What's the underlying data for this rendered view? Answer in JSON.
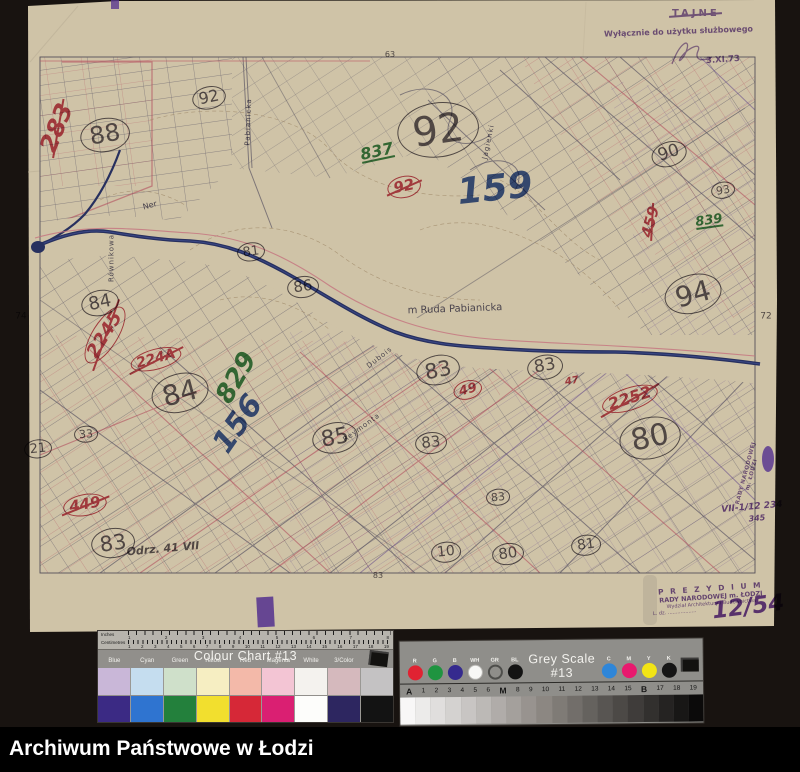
{
  "palette": {
    "background": "#181310",
    "paper": "#cfc3a7",
    "river": "#27305f",
    "pencil": "#55505a",
    "red": "#c13c4e",
    "green": "#2f7d3f",
    "blue": "#30509f",
    "purple": "#6b43a0",
    "ink": "#4d4a6a"
  },
  "archive_bar": {
    "label": "Archiwum Państwowe w Łodzi"
  },
  "stamps": {
    "top_right": {
      "secret": "TAJNE",
      "usage": "Wyłącznie do użytku służbowego",
      "date": "3.XI.73"
    },
    "bottom_right": {
      "line1": "P R E Z Y D I U M",
      "line2": "RADY NARODOWEJ m. ŁODZI",
      "line3": "Wydział Architektury i Budownictwa",
      "line4": "L. dz. ..................",
      "number": "12/54"
    },
    "right_edge": {
      "line1": "RADY NARODOWEJ",
      "line2": "m. ŁODZI",
      "note1": "VII-1/12 234",
      "note2": "345"
    }
  },
  "map": {
    "annotations": [
      {
        "text": "m Ruda Pabianicka",
        "x": 455,
        "y": 310,
        "size": 10,
        "color": "ink",
        "rot": -2
      },
      {
        "text": "Równikowa",
        "x": 112,
        "y": 258,
        "size": 7,
        "color": "ink",
        "rot": -90,
        "sp": true
      },
      {
        "text": "Pabianicka",
        "x": 249,
        "y": 122,
        "size": 7,
        "color": "ink",
        "rot": -88,
        "sp": true
      },
      {
        "text": "Jagienki",
        "x": 489,
        "y": 142,
        "size": 7,
        "color": "ink",
        "rot": -78,
        "sp": true
      },
      {
        "text": "Dubois",
        "x": 380,
        "y": 358,
        "size": 7,
        "color": "ink",
        "rot": -38,
        "sp": true
      },
      {
        "text": "Reymonta",
        "x": 362,
        "y": 428,
        "size": 7,
        "color": "ink",
        "rot": -36,
        "sp": true
      },
      {
        "text": "Ner",
        "x": 150,
        "y": 206,
        "size": 8,
        "color": "ink",
        "rot": -15
      },
      {
        "text": "88",
        "x": 105,
        "y": 135,
        "size": 24,
        "color": "pencil",
        "circle": true,
        "rot": -10
      },
      {
        "text": "92",
        "x": 209,
        "y": 98,
        "size": 16,
        "color": "pencil",
        "circle": true,
        "rot": -12
      },
      {
        "text": "92",
        "x": 438,
        "y": 130,
        "size": 40,
        "color": "pencil",
        "circle": true,
        "rot": -8
      },
      {
        "text": "81",
        "x": 251,
        "y": 252,
        "size": 13,
        "color": "pencil",
        "circle": true,
        "rot": -8
      },
      {
        "text": "86",
        "x": 303,
        "y": 287,
        "size": 15,
        "color": "pencil",
        "circle": true,
        "rot": -8
      },
      {
        "text": "84",
        "x": 100,
        "y": 303,
        "size": 18,
        "color": "pencil",
        "circle": true,
        "rot": -12
      },
      {
        "text": "84",
        "x": 180,
        "y": 393,
        "size": 28,
        "color": "pencil",
        "circle": true,
        "rot": -15
      },
      {
        "text": "85",
        "x": 335,
        "y": 438,
        "size": 22,
        "color": "pencil",
        "circle": true,
        "rot": -10
      },
      {
        "text": "83",
        "x": 438,
        "y": 370,
        "size": 21,
        "color": "pencil",
        "circle": true,
        "rot": -12
      },
      {
        "text": "83",
        "x": 431,
        "y": 443,
        "size": 15,
        "color": "pencil",
        "circle": true,
        "rot": -6
      },
      {
        "text": "83",
        "x": 113,
        "y": 543,
        "size": 21,
        "color": "pencil",
        "circle": true,
        "rot": -8
      },
      {
        "text": "83",
        "x": 545,
        "y": 367,
        "size": 17,
        "color": "pencil",
        "circle": true,
        "rot": -10
      },
      {
        "text": "80",
        "x": 650,
        "y": 438,
        "size": 30,
        "color": "pencil",
        "circle": true,
        "rot": -12
      },
      {
        "text": "94",
        "x": 693,
        "y": 294,
        "size": 28,
        "color": "pencil",
        "circle": true,
        "rot": -15
      },
      {
        "text": "90",
        "x": 669,
        "y": 154,
        "size": 17,
        "color": "pencil",
        "circle": true,
        "rot": -18
      },
      {
        "text": "93",
        "x": 723,
        "y": 190,
        "size": 11,
        "color": "pencil",
        "circle": true,
        "rot": -10
      },
      {
        "text": "10",
        "x": 446,
        "y": 552,
        "size": 14,
        "color": "pencil",
        "circle": true,
        "rot": -6
      },
      {
        "text": "80",
        "x": 508,
        "y": 554,
        "size": 15,
        "color": "pencil",
        "circle": true,
        "rot": -8
      },
      {
        "text": "81",
        "x": 586,
        "y": 545,
        "size": 14,
        "color": "pencil",
        "circle": true,
        "rot": -8
      },
      {
        "text": "21",
        "x": 38,
        "y": 449,
        "size": 13,
        "color": "pencil",
        "circle": true,
        "rot": -6
      },
      {
        "text": "33",
        "x": 86,
        "y": 434,
        "size": 11,
        "color": "pencil",
        "circle": true,
        "rot": -4
      },
      {
        "text": "83",
        "x": 498,
        "y": 497,
        "size": 11,
        "color": "pencil",
        "circle": true,
        "rot": -6
      },
      {
        "text": "63",
        "x": 390,
        "y": 55,
        "size": 8,
        "color": "pencil"
      },
      {
        "text": "83",
        "x": 378,
        "y": 576,
        "size": 8,
        "color": "pencil"
      },
      {
        "text": "74",
        "x": 21,
        "y": 317,
        "size": 9,
        "color": "pencil"
      },
      {
        "text": "72",
        "x": 766,
        "y": 317,
        "size": 9,
        "color": "pencil"
      },
      {
        "text": "Odrz. 41 VII",
        "x": 163,
        "y": 549,
        "size": 11,
        "color": "pencil",
        "rot": -5,
        "hand": true
      },
      {
        "text": "283",
        "x": 57,
        "y": 128,
        "size": 24,
        "color": "red",
        "rot": -68,
        "cross": true,
        "hand": true
      },
      {
        "text": "92",
        "x": 404,
        "y": 187,
        "size": 15,
        "color": "red",
        "circle": true,
        "cross": true,
        "rot": -12,
        "hand": true
      },
      {
        "text": "2245",
        "x": 105,
        "y": 335,
        "size": 18,
        "color": "red",
        "rot": -58,
        "circle": true,
        "cross": true,
        "hand": true
      },
      {
        "text": "224A",
        "x": 156,
        "y": 359,
        "size": 14,
        "color": "red",
        "rot": -15,
        "circle": true,
        "cross": true,
        "hand": true
      },
      {
        "text": "2252",
        "x": 630,
        "y": 399,
        "size": 16,
        "color": "red",
        "rot": -18,
        "circle": true,
        "cross": true,
        "hand": true
      },
      {
        "text": "459",
        "x": 651,
        "y": 222,
        "size": 15,
        "color": "red",
        "rot": -75,
        "cross": true,
        "hand": true
      },
      {
        "text": "49",
        "x": 468,
        "y": 390,
        "size": 13,
        "color": "red",
        "circle": true,
        "rot": -15,
        "hand": true
      },
      {
        "text": "449",
        "x": 85,
        "y": 505,
        "size": 15,
        "color": "red",
        "circle": true,
        "cross": true,
        "rot": -10,
        "hand": true
      },
      {
        "text": "47",
        "x": 572,
        "y": 382,
        "size": 10,
        "color": "red",
        "rot": -10,
        "hand": true
      },
      {
        "text": "837",
        "x": 377,
        "y": 152,
        "size": 16,
        "color": "green",
        "rot": -12,
        "underline": true,
        "hand": true
      },
      {
        "text": "829",
        "x": 237,
        "y": 378,
        "size": 26,
        "color": "green",
        "rot": -60,
        "hand": true
      },
      {
        "text": "839",
        "x": 709,
        "y": 221,
        "size": 13,
        "color": "green",
        "rot": -8,
        "underline": true,
        "hand": true
      },
      {
        "text": "159",
        "x": 495,
        "y": 189,
        "size": 36,
        "color": "blue",
        "rot": -6,
        "hand": true
      },
      {
        "text": "156",
        "x": 238,
        "y": 424,
        "size": 30,
        "color": "blue",
        "rot": -55,
        "hand": true
      },
      {
        "text": "VII-1/12 234",
        "x": 752,
        "y": 508,
        "size": 9,
        "color": "purple",
        "rot": -5,
        "hand": true
      },
      {
        "text": "345",
        "x": 757,
        "y": 519,
        "size": 8,
        "color": "purple",
        "rot": -5,
        "hand": true
      }
    ]
  },
  "colour_chart": {
    "title": "Colour Chart #13",
    "ruler": {
      "inches_label": "Inches",
      "cm_label": "Centimetres",
      "inch_numbers": [
        "1",
        "2",
        "3",
        "4",
        "5",
        "6",
        "7",
        "8"
      ],
      "cm_numbers": [
        "1",
        "2",
        "3",
        "4",
        "5",
        "6",
        "7",
        "8",
        "9",
        "10",
        "11",
        "12",
        "13",
        "14",
        "15",
        "16",
        "17",
        "18",
        "19"
      ]
    },
    "columns": [
      {
        "label": "Blue",
        "tint": "#c9b7d8",
        "solid": "#3b2a84"
      },
      {
        "label": "Cyan",
        "tint": "#c5ddef",
        "solid": "#2f74d0"
      },
      {
        "label": "Green",
        "tint": "#cfe0ca",
        "solid": "#23803c"
      },
      {
        "label": "Yellow",
        "tint": "#f6eec2",
        "solid": "#f2df2e"
      },
      {
        "label": "Red",
        "tint": "#f3b9a9",
        "solid": "#d62837"
      },
      {
        "label": "Magenta",
        "tint": "#f3c5d4",
        "solid": "#da1f72"
      },
      {
        "label": "White",
        "tint": "#f4f2ee",
        "solid": "#fdfdfb"
      },
      {
        "label": "3/Color",
        "tint": "#d5b9bd",
        "solid": "#2d2660"
      },
      {
        "label": "Black",
        "tint": "#c4c2c3",
        "solid": "#131313"
      }
    ]
  },
  "grey_scale": {
    "title": "Grey Scale #13",
    "left_circles": [
      {
        "label": "R",
        "color": "#e02232"
      },
      {
        "label": "G",
        "color": "#1f9440"
      },
      {
        "label": "B",
        "color": "#352a8e"
      },
      {
        "label": "WH",
        "color": "#f8f8f6"
      },
      {
        "label": "GR",
        "color": "outline"
      },
      {
        "label": "BL",
        "color": "#131313"
      }
    ],
    "right_circles": [
      {
        "label": "C",
        "color": "#2f86d8"
      },
      {
        "label": "M",
        "color": "#e8196e"
      },
      {
        "label": "Y",
        "color": "#f2e415"
      },
      {
        "label": "K",
        "color": "#151515"
      }
    ],
    "scale_labels": [
      "A",
      "1",
      "2",
      "3",
      "4",
      "5",
      "6",
      "M",
      "8",
      "9",
      "10",
      "11",
      "12",
      "13",
      "14",
      "15",
      "B",
      "17",
      "18",
      "19"
    ],
    "steps": 20
  }
}
